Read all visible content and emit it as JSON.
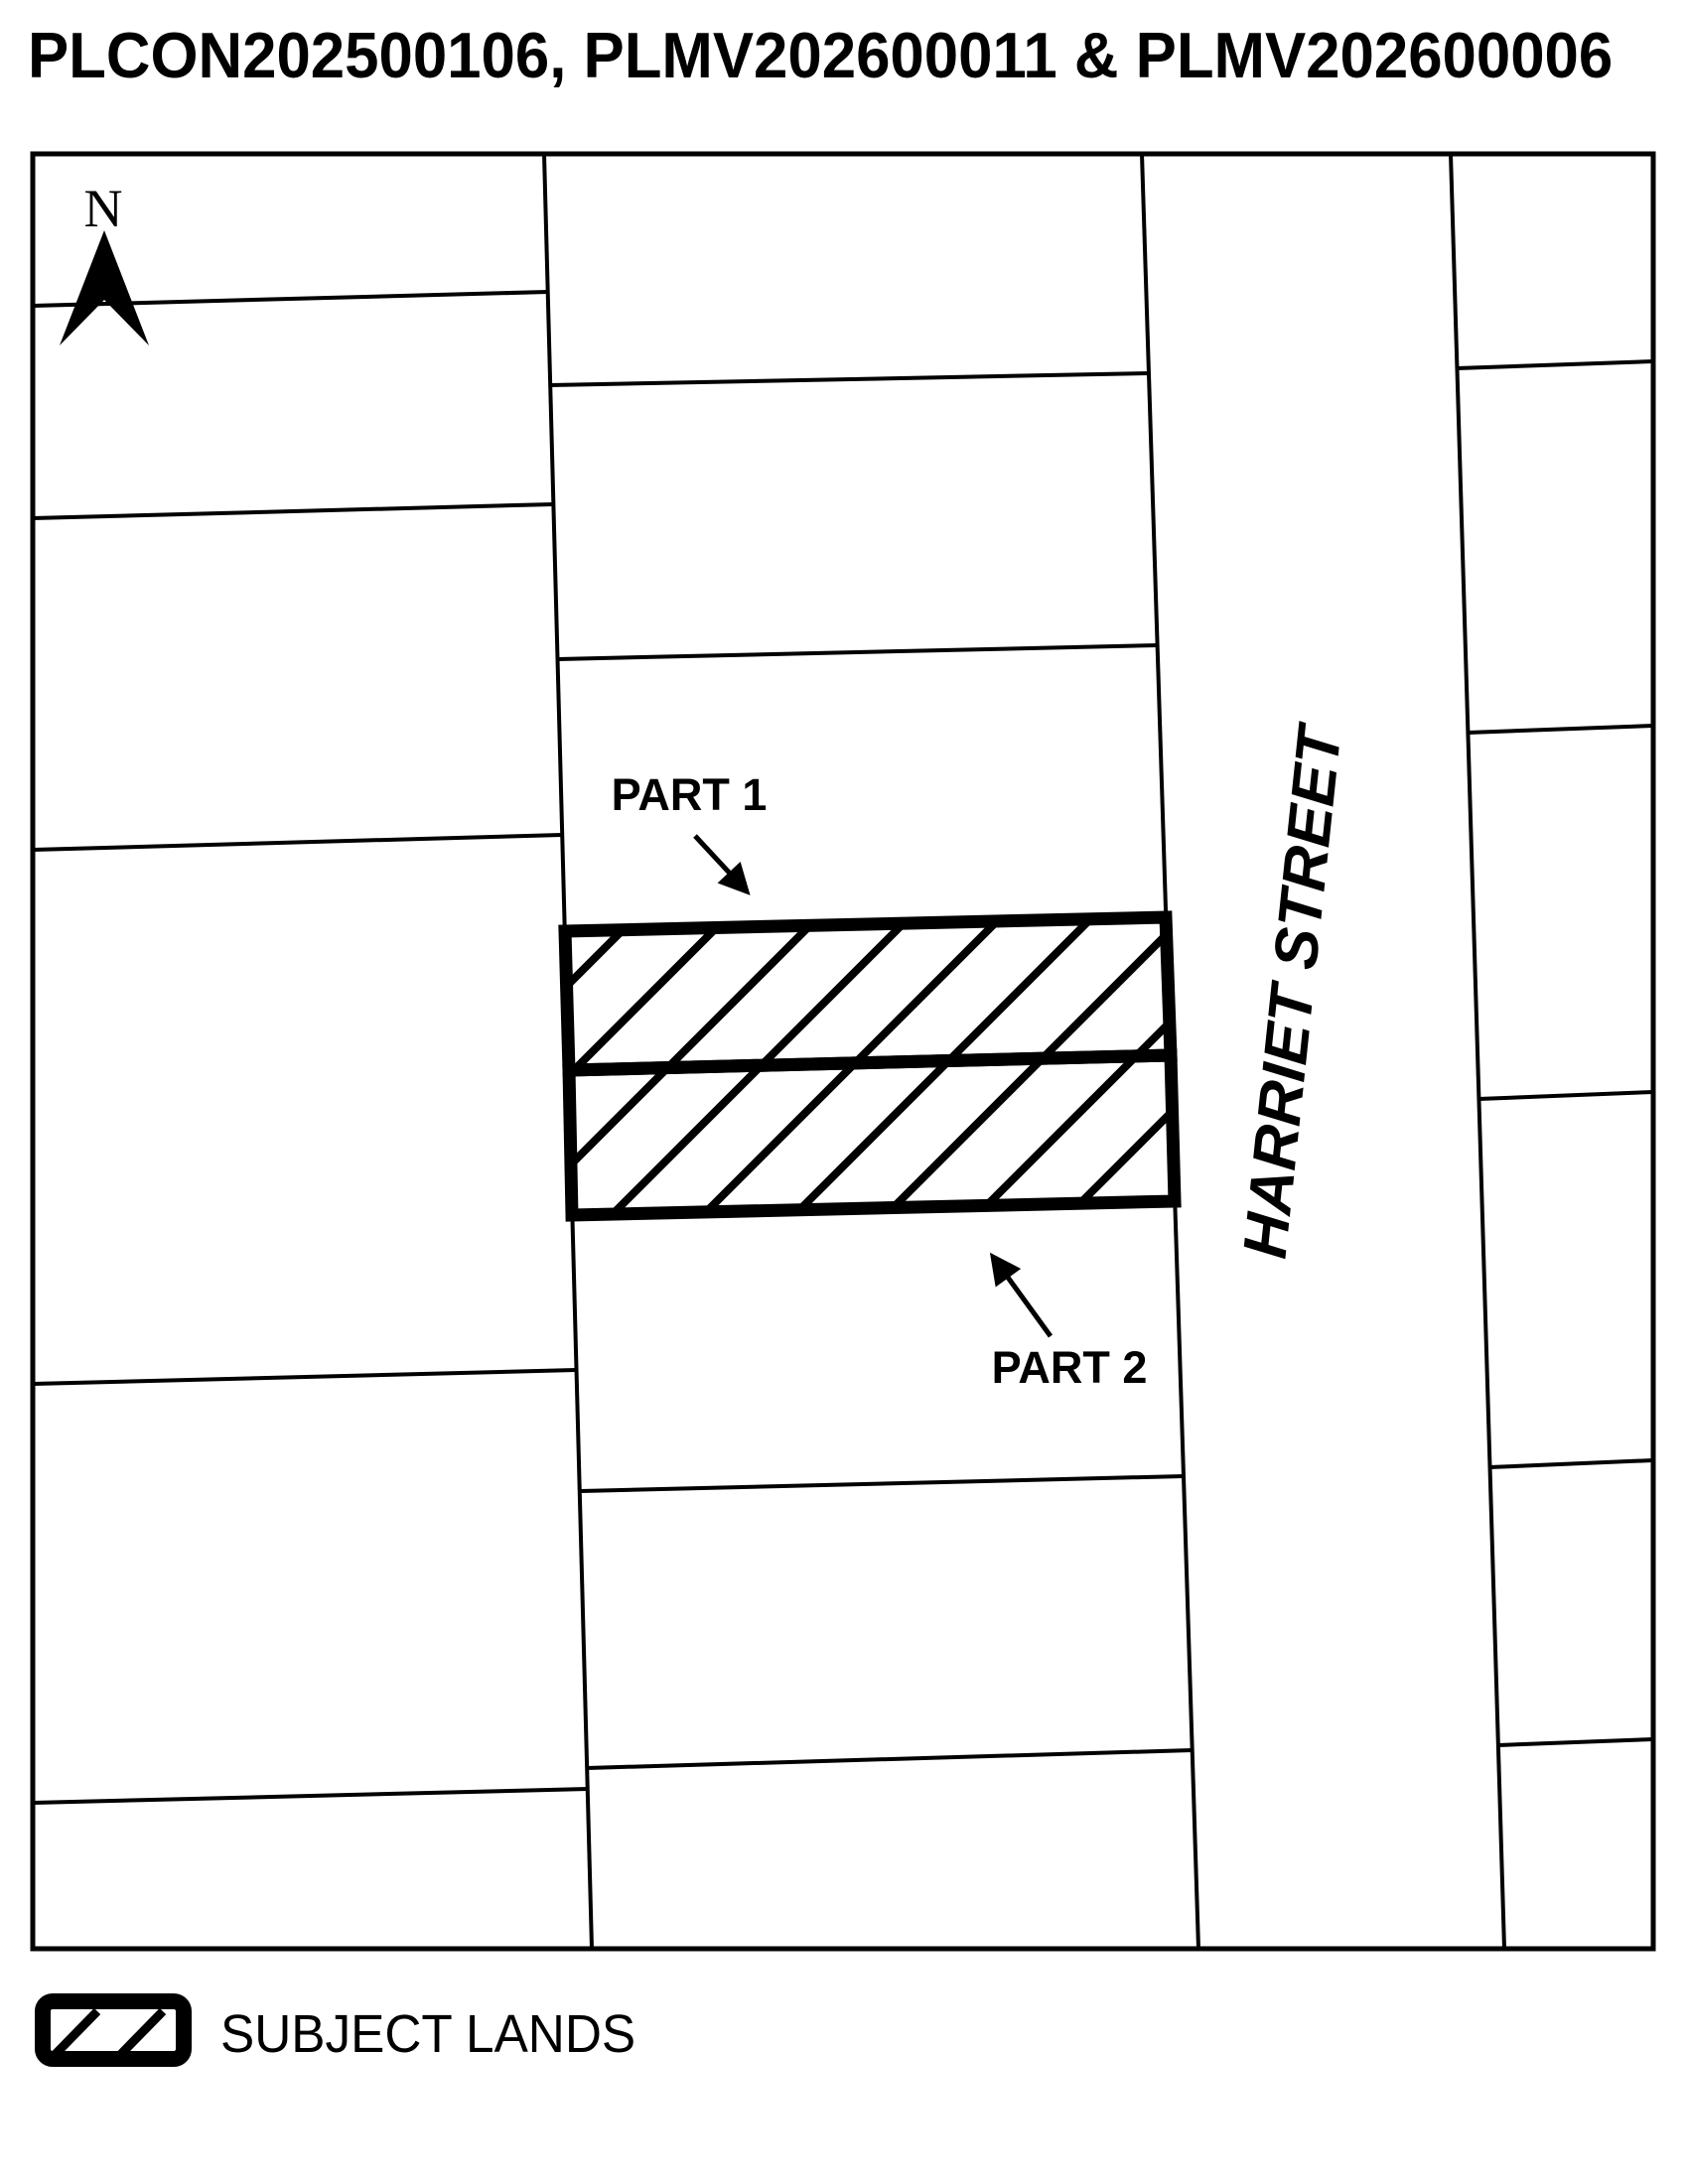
{
  "title": "PLCON202500106, PLMV202600011 & PLMV202600006",
  "map": {
    "north_label": "N",
    "street_name": "HARRIET STREET",
    "labels": {
      "part1": "PART 1",
      "part2": "PART 2"
    },
    "icons": {
      "north_arrow": "north-arrow",
      "part1_leader": "leader-arrow-down-right",
      "part2_leader": "leader-arrow-up-left"
    }
  },
  "legend": {
    "items": [
      {
        "swatch": "hatched-parcel-swatch",
        "label": "SUBJECT LANDS"
      }
    ]
  },
  "colors": {
    "ink": "#000000",
    "paper": "#ffffff"
  }
}
